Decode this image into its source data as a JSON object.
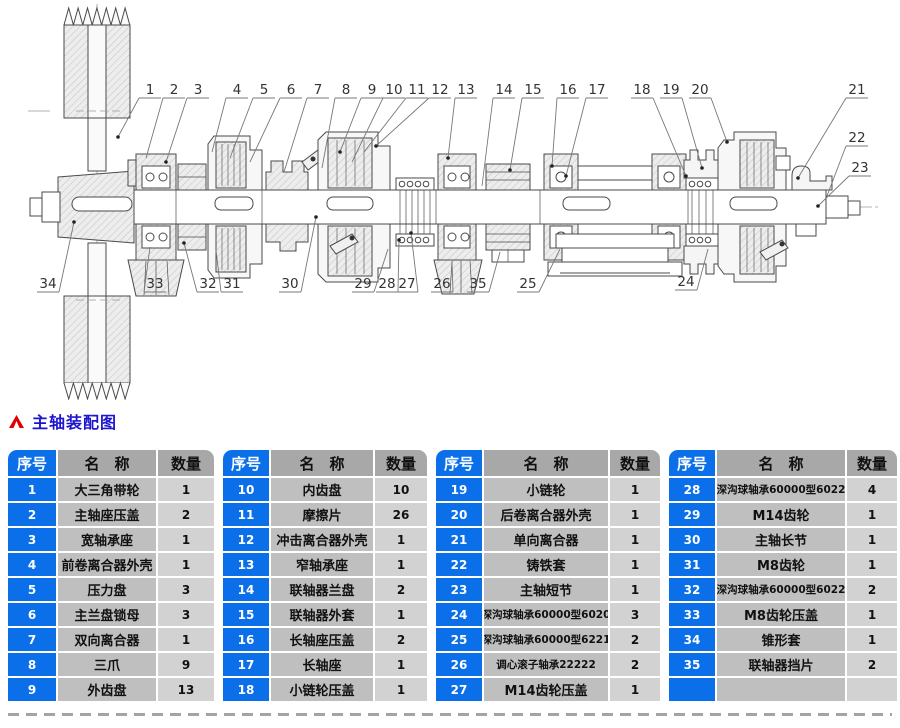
{
  "header": {
    "title": "主轴装配图"
  },
  "colors": {
    "accent_blue": "#0a6fe8",
    "accent_blue_light": "#58a8f5",
    "title_blue": "#1d14cf",
    "arrow_red": "#e00000",
    "header_gray": "#a8a8a8",
    "name_cell": "#bfbfbf",
    "qty_cell": "#d2d2d2"
  },
  "table_headers": {
    "no": "序号",
    "name": "名　称",
    "qty": "数量"
  },
  "parts_tables": [
    {
      "rows": [
        {
          "no": "1",
          "name": "大三角带轮",
          "qty": "1"
        },
        {
          "no": "2",
          "name": "主轴座压盖",
          "qty": "2"
        },
        {
          "no": "3",
          "name": "宽轴承座",
          "qty": "1"
        },
        {
          "no": "4",
          "name": "前卷离合器外壳",
          "qty": "1"
        },
        {
          "no": "5",
          "name": "压力盘",
          "qty": "3"
        },
        {
          "no": "6",
          "name": "主兰盘锁母",
          "qty": "3"
        },
        {
          "no": "7",
          "name": "双向离合器",
          "qty": "1"
        },
        {
          "no": "8",
          "name": "三爪",
          "qty": "9"
        },
        {
          "no": "9",
          "name": "外齿盘",
          "qty": "13"
        }
      ]
    },
    {
      "rows": [
        {
          "no": "10",
          "name": "内齿盘",
          "qty": "10"
        },
        {
          "no": "11",
          "name": "摩擦片",
          "qty": "26"
        },
        {
          "no": "12",
          "name": "冲击离合器外壳",
          "qty": "1"
        },
        {
          "no": "13",
          "name": "窄轴承座",
          "qty": "1"
        },
        {
          "no": "14",
          "name": "联轴器兰盘",
          "qty": "2"
        },
        {
          "no": "15",
          "name": "联轴器外套",
          "qty": "1"
        },
        {
          "no": "16",
          "name": "长轴座压盖",
          "qty": "2"
        },
        {
          "no": "17",
          "name": "长轴座",
          "qty": "1"
        },
        {
          "no": "18",
          "name": "小链轮压盖",
          "qty": "1"
        }
      ]
    },
    {
      "rows": [
        {
          "no": "19",
          "name": "小链轮",
          "qty": "1"
        },
        {
          "no": "20",
          "name": "后卷离合器外壳",
          "qty": "1"
        },
        {
          "no": "21",
          "name": "单向离合器",
          "qty": "1"
        },
        {
          "no": "22",
          "name": "铸铁套",
          "qty": "1"
        },
        {
          "no": "23",
          "name": "主轴短节",
          "qty": "1"
        },
        {
          "no": "24",
          "name": "深沟球轴承60000型6020",
          "qty": "3"
        },
        {
          "no": "25",
          "name": "深沟球轴承60000型6221",
          "qty": "2"
        },
        {
          "no": "26",
          "name": "调心滚子轴承22222",
          "qty": "2"
        },
        {
          "no": "27",
          "name": "M14齿轮压盖",
          "qty": "1"
        }
      ]
    },
    {
      "rows": [
        {
          "no": "28",
          "name": "深沟球轴承60000型6022",
          "qty": "4"
        },
        {
          "no": "29",
          "name": "M14齿轮",
          "qty": "1"
        },
        {
          "no": "30",
          "name": "主轴长节",
          "qty": "1"
        },
        {
          "no": "31",
          "name": "M8齿轮",
          "qty": "1"
        },
        {
          "no": "32",
          "name": "深沟球轴承60000型6022",
          "qty": "2"
        },
        {
          "no": "33",
          "name": "M8齿轮压盖",
          "qty": "1"
        },
        {
          "no": "34",
          "name": "锥形套",
          "qty": "1"
        },
        {
          "no": "35",
          "name": "联轴器挡片",
          "qty": "2"
        },
        {
          "no": "",
          "name": "",
          "qty": "",
          "empty": true
        }
      ]
    }
  ],
  "diagram": {
    "callouts": [
      {
        "n": "1",
        "x": 150,
        "y": 90,
        "tx": 118,
        "ty": 137,
        "side": "top",
        "dot": true
      },
      {
        "n": "2",
        "x": 174,
        "y": 90,
        "tx": 146,
        "ty": 158,
        "side": "top",
        "dot": false
      },
      {
        "n": "3",
        "x": 198,
        "y": 90,
        "tx": 166,
        "ty": 162,
        "side": "top",
        "dot": true
      },
      {
        "n": "4",
        "x": 237,
        "y": 90,
        "tx": 212,
        "ty": 152,
        "side": "top",
        "dot": false
      },
      {
        "n": "5",
        "x": 264,
        "y": 90,
        "tx": 230,
        "ty": 158,
        "side": "top",
        "dot": false
      },
      {
        "n": "6",
        "x": 291,
        "y": 90,
        "tx": 250,
        "ty": 162,
        "side": "top",
        "dot": false
      },
      {
        "n": "7",
        "x": 318,
        "y": 90,
        "tx": 284,
        "ty": 172,
        "side": "top",
        "dot": false
      },
      {
        "n": "8",
        "x": 346,
        "y": 90,
        "tx": 322,
        "ty": 168,
        "side": "top",
        "dot": false
      },
      {
        "n": "9",
        "x": 372,
        "y": 90,
        "tx": 340,
        "ty": 152,
        "side": "top",
        "dot": true
      },
      {
        "n": "10",
        "x": 394,
        "y": 90,
        "tx": 352,
        "ty": 162,
        "side": "top",
        "dot": false
      },
      {
        "n": "11",
        "x": 417,
        "y": 90,
        "tx": 364,
        "ty": 152,
        "side": "top",
        "dot": false
      },
      {
        "n": "12",
        "x": 440,
        "y": 90,
        "tx": 376,
        "ty": 146,
        "side": "top",
        "dot": true
      },
      {
        "n": "13",
        "x": 466,
        "y": 90,
        "tx": 448,
        "ty": 158,
        "side": "top",
        "dot": true
      },
      {
        "n": "14",
        "x": 504,
        "y": 90,
        "tx": 482,
        "ty": 186,
        "side": "top",
        "dot": false
      },
      {
        "n": "15",
        "x": 533,
        "y": 90,
        "tx": 510,
        "ty": 170,
        "side": "top",
        "dot": true
      },
      {
        "n": "16",
        "x": 568,
        "y": 90,
        "tx": 552,
        "ty": 166,
        "side": "top",
        "dot": true
      },
      {
        "n": "17",
        "x": 597,
        "y": 90,
        "tx": 566,
        "ty": 176,
        "side": "top",
        "dot": true
      },
      {
        "n": "18",
        "x": 642,
        "y": 90,
        "tx": 686,
        "ty": 176,
        "side": "top",
        "dot": true
      },
      {
        "n": "19",
        "x": 671,
        "y": 90,
        "tx": 702,
        "ty": 168,
        "side": "top",
        "dot": true
      },
      {
        "n": "20",
        "x": 700,
        "y": 90,
        "tx": 727,
        "ty": 142,
        "side": "top",
        "dot": true
      },
      {
        "n": "21",
        "x": 857,
        "y": 90,
        "tx": 798,
        "ty": 178,
        "side": "right",
        "dot": true
      },
      {
        "n": "22",
        "x": 857,
        "y": 138,
        "tx": 827,
        "ty": 196,
        "side": "right",
        "dot": false
      },
      {
        "n": "23",
        "x": 860,
        "y": 168,
        "tx": 818,
        "ty": 206,
        "side": "right",
        "dot": true
      },
      {
        "n": "34",
        "x": 48,
        "y": 284,
        "tx": 74,
        "ty": 222,
        "side": "bottom",
        "dot": true
      },
      {
        "n": "33",
        "x": 155,
        "y": 284,
        "tx": 150,
        "ty": 247,
        "side": "bottom",
        "dot": false
      },
      {
        "n": "32",
        "x": 208,
        "y": 284,
        "tx": 184,
        "ty": 243,
        "side": "bottom",
        "dot": true
      },
      {
        "n": "31",
        "x": 232,
        "y": 284,
        "tx": 216,
        "ty": 250,
        "side": "bottom",
        "dot": false
      },
      {
        "n": "30",
        "x": 290,
        "y": 284,
        "tx": 316,
        "ty": 217,
        "side": "bottom",
        "dot": true
      },
      {
        "n": "29",
        "x": 363,
        "y": 284,
        "tx": 388,
        "ty": 249,
        "side": "bottom",
        "dot": false
      },
      {
        "n": "28",
        "x": 387,
        "y": 284,
        "tx": 399,
        "ty": 240,
        "side": "bottom",
        "dot": true
      },
      {
        "n": "27",
        "x": 407,
        "y": 284,
        "tx": 411,
        "ty": 233,
        "side": "bottom",
        "dot": true
      },
      {
        "n": "26",
        "x": 442,
        "y": 284,
        "tx": 452,
        "ty": 262,
        "side": "bottom",
        "dot": false
      },
      {
        "n": "35",
        "x": 478,
        "y": 284,
        "tx": 500,
        "ty": 252,
        "side": "bottom",
        "dot": false
      },
      {
        "n": "25",
        "x": 528,
        "y": 284,
        "tx": 560,
        "ty": 249,
        "side": "bottom",
        "dot": false
      },
      {
        "n": "24",
        "x": 686,
        "y": 282,
        "tx": 708,
        "ty": 249,
        "side": "bottom",
        "dot": false
      }
    ]
  }
}
